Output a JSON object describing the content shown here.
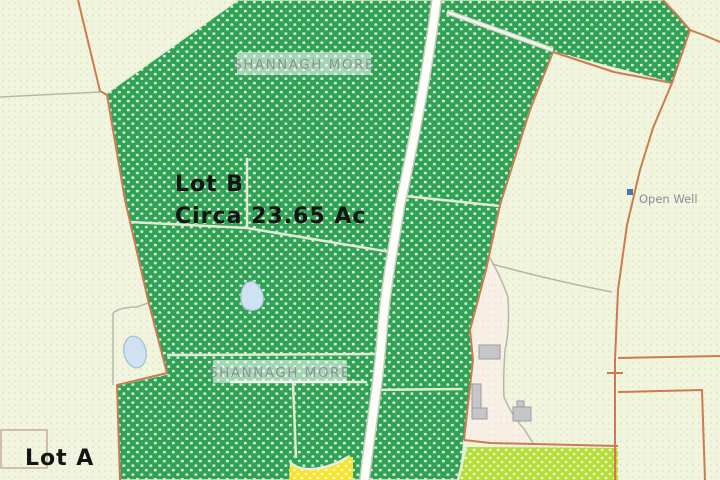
{
  "map": {
    "kind": "cadastral-sale-map",
    "townland_labels": [
      {
        "text": "SHANNAGH MORE"
      },
      {
        "text": "SHANNAGH MORE"
      }
    ],
    "lots": {
      "lot_b": {
        "name": "Lot B",
        "area": "Circa 23.65 Ac"
      },
      "lot_a": {
        "name": "Lot A"
      }
    },
    "poi": {
      "open_well": "Open Well"
    },
    "colors": {
      "field_green": "#2fa257",
      "field_green_dot": "#d9efd0",
      "pale_ground": "#f1f5dd",
      "chartreuse_field": "#b5dd36",
      "yellow_patch": "#f6e430",
      "farmyard": "#f8efe5",
      "boundary_orange": "#cd7a50",
      "track_white": "#ffffff",
      "gray_line": "#b4b8ac",
      "building_gray": "#c6c6c8",
      "pond_blue": "#cfe2f1",
      "well_blue": "#4a74b4",
      "label_gray": "#8e8e96"
    }
  }
}
